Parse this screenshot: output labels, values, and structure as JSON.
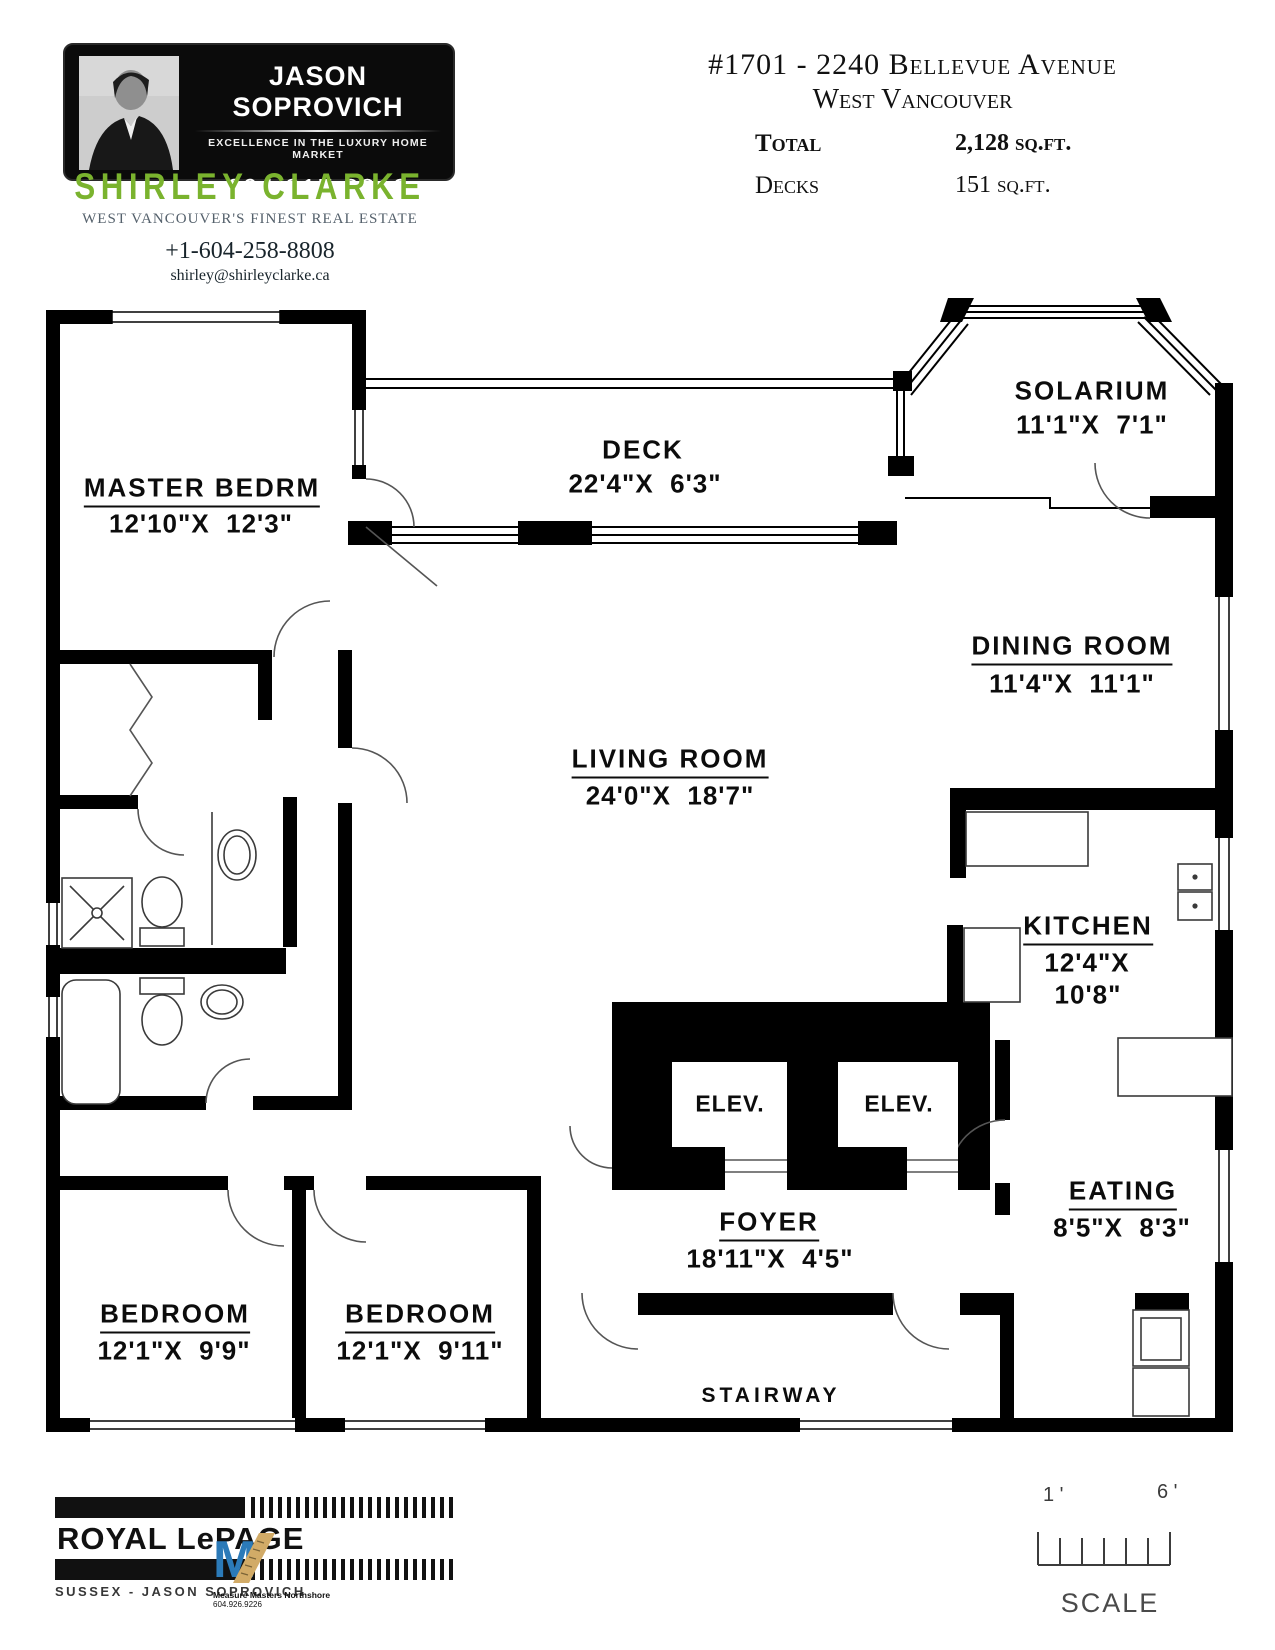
{
  "header": {
    "agent_card": {
      "name": "JASON SOPROVICH",
      "tagline": "EXCELLENCE IN THE LUXURY HOME MARKET",
      "phone": "604.817.8812"
    },
    "brokerage": {
      "name": "SHIRLEY CLARKE",
      "tagline": "WEST VANCOUVER'S FINEST REAL ESTATE",
      "phone": "+1-604-258-8808",
      "email": "shirley@shirleyclarke.ca",
      "brand_color": "#7ab32e"
    },
    "listing": {
      "address_line1": "#1701 - 2240 Bellevue Avenue",
      "address_line2": "West Vancouver",
      "areas": [
        {
          "label": "Total",
          "value": "2,128 sq.ft.",
          "bold": true
        },
        {
          "label": "Decks",
          "value": "151 sq.ft.",
          "bold": false
        }
      ]
    }
  },
  "floor_plan": {
    "rooms": [
      {
        "name": "MASTER BEDRM",
        "nx": 202,
        "ny": 490,
        "underline": true,
        "dims": "12'10\"X  12'3\"",
        "dx": 201,
        "dy": 524
      },
      {
        "name": "DECK",
        "nx": 643,
        "ny": 450,
        "underline": false,
        "dims": "22'4\"X  6'3\"",
        "dx": 645,
        "dy": 484
      },
      {
        "name": "SOLARIUM",
        "nx": 1092,
        "ny": 391,
        "underline": false,
        "dims": "11'1\"X  7'1\"",
        "dx": 1092,
        "dy": 425
      },
      {
        "name": "DINING ROOM",
        "nx": 1072,
        "ny": 648,
        "underline": true,
        "dims": "11'4\"X  11'1\"",
        "dx": 1072,
        "dy": 684
      },
      {
        "name": "LIVING ROOM",
        "nx": 670,
        "ny": 761,
        "underline": true,
        "dims": "24'0\"X  18'7\"",
        "dx": 670,
        "dy": 796
      },
      {
        "name": "KITCHEN",
        "nx": 1088,
        "ny": 928,
        "underline": true,
        "dims": "12'4\"X",
        "dx": 1087,
        "dy": 963,
        "dims2": "10'8\"",
        "d2x": 1088,
        "d2y": 995
      },
      {
        "name": "ELEV.",
        "nx": 730,
        "ny": 1104,
        "underline": false,
        "style": "small"
      },
      {
        "name": "ELEV.",
        "nx": 899,
        "ny": 1104,
        "underline": false,
        "style": "small"
      },
      {
        "name": "FOYER",
        "nx": 769,
        "ny": 1224,
        "underline": true,
        "dims": "18'11\"X  4'5\"",
        "dx": 770,
        "dy": 1259
      },
      {
        "name": "EATING",
        "nx": 1123,
        "ny": 1193,
        "underline": true,
        "dims": "8'5\"X  8'3\"",
        "dx": 1122,
        "dy": 1228
      },
      {
        "name": "BEDROOM",
        "nx": 175,
        "ny": 1316,
        "underline": true,
        "dims": "12'1\"X  9'9\"",
        "dx": 174,
        "dy": 1351
      },
      {
        "name": "BEDROOM",
        "nx": 420,
        "ny": 1316,
        "underline": true,
        "dims": "12'1\"X  9'11\"",
        "dx": 420,
        "dy": 1351
      },
      {
        "name": "STAIRWAY",
        "nx": 771,
        "ny": 1396,
        "underline": false,
        "style": "wide"
      }
    ]
  },
  "footer": {
    "royal_lepage": {
      "wordmark": "ROYAL LePAGE",
      "subline": "SUSSEX - JASON SOPROVICH"
    },
    "measure_masters": {
      "name": "Measure Masters Northshore",
      "phone": "604.926.9226"
    },
    "scale": {
      "left_tick": "1 '",
      "right_tick": "6 '",
      "label": "SCALE"
    }
  }
}
